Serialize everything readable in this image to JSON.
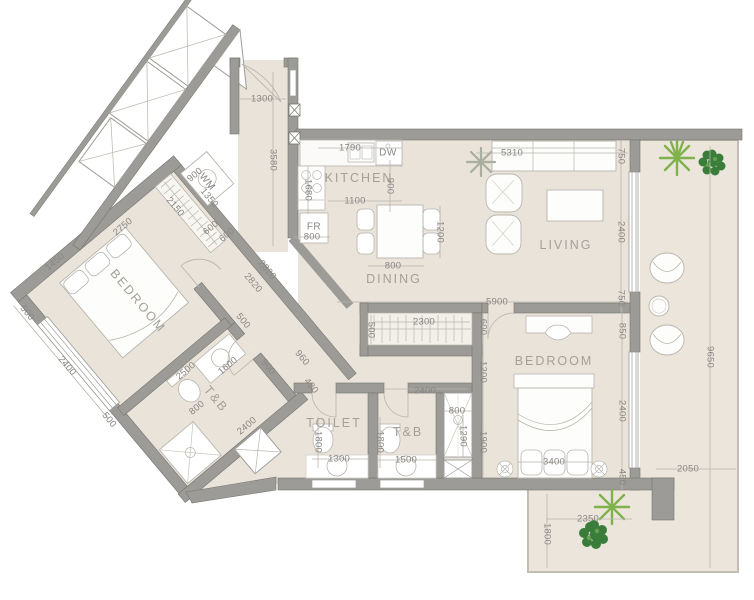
{
  "plan": {
    "type": "architectural floor plan",
    "units": "mm"
  },
  "colors": {
    "floor": "#e9e3da",
    "balcony_floor": "#ebe5dc",
    "wall": "#9c9b97",
    "wall_edge": "#76756f",
    "furniture_line": "#b9b5ad",
    "dim_line": "#b8b4ac",
    "dim_text": "#8a8784",
    "room_text": "#a4a098",
    "plant_light": "#7fb24b",
    "plant_dark": "#3a7d3b",
    "plant_gray": "#a9ae9e"
  },
  "labels": {
    "rooms": [
      {
        "text": "KITCHEN",
        "x": 359,
        "y": 178,
        "rot": 0
      },
      {
        "text": "DINING",
        "x": 394,
        "y": 279,
        "rot": 0
      },
      {
        "text": "LIVING",
        "x": 566,
        "y": 245,
        "rot": 0
      },
      {
        "text": "BEDROOM",
        "x": 554,
        "y": 361,
        "rot": 0
      },
      {
        "text": "BEDROOM",
        "x": 138,
        "y": 301,
        "rot": 50
      },
      {
        "text": "TOILET",
        "x": 334,
        "y": 423,
        "rot": 0
      },
      {
        "text": "T&B",
        "x": 408,
        "y": 432,
        "rot": 0
      },
      {
        "text": "T&B",
        "x": 216,
        "y": 399,
        "rot": 50
      }
    ],
    "appliances": [
      {
        "text": "DW",
        "x": 388,
        "y": 153,
        "rot": 0
      },
      {
        "text": "FR",
        "x": 314,
        "y": 227,
        "rot": 0
      },
      {
        "text": "WM",
        "x": 207,
        "y": 182,
        "rot": 50
      }
    ],
    "dimensions": [
      {
        "text": "1300",
        "x": 262,
        "y": 99,
        "rot": 0
      },
      {
        "text": "3580",
        "x": 273,
        "y": 160,
        "rot": 90
      },
      {
        "text": "1790",
        "x": 350,
        "y": 148,
        "rot": 0
      },
      {
        "text": "900",
        "x": 390,
        "y": 186,
        "rot": 90
      },
      {
        "text": "1680",
        "x": 308,
        "y": 190,
        "rot": 90
      },
      {
        "text": "1100",
        "x": 355,
        "y": 201,
        "rot": 0
      },
      {
        "text": "800",
        "x": 312,
        "y": 237,
        "rot": 0
      },
      {
        "text": "800",
        "x": 393,
        "y": 266,
        "rot": 0
      },
      {
        "text": "1200",
        "x": 440,
        "y": 232,
        "rot": 90
      },
      {
        "text": "5310",
        "x": 512,
        "y": 153,
        "rot": 0
      },
      {
        "text": "750",
        "x": 621,
        "y": 156,
        "rot": 90
      },
      {
        "text": "2400",
        "x": 621,
        "y": 232,
        "rot": 90
      },
      {
        "text": "750",
        "x": 621,
        "y": 298,
        "rot": 90
      },
      {
        "text": "5900",
        "x": 497,
        "y": 302,
        "rot": 0
      },
      {
        "text": "2300",
        "x": 424,
        "y": 322,
        "rot": 0
      },
      {
        "text": "500",
        "x": 371,
        "y": 330,
        "rot": 90
      },
      {
        "text": "600",
        "x": 483,
        "y": 327,
        "rot": 90
      },
      {
        "text": "1200",
        "x": 483,
        "y": 372,
        "rot": 90
      },
      {
        "text": "1900",
        "x": 483,
        "y": 442,
        "rot": 90
      },
      {
        "text": "850",
        "x": 622,
        "y": 331,
        "rot": 90
      },
      {
        "text": "2400",
        "x": 622,
        "y": 411,
        "rot": 90
      },
      {
        "text": "450",
        "x": 622,
        "y": 477,
        "rot": 90
      },
      {
        "text": "3400",
        "x": 554,
        "y": 462,
        "rot": 0
      },
      {
        "text": "2400",
        "x": 425,
        "y": 391,
        "rot": 0
      },
      {
        "text": "800",
        "x": 457,
        "y": 411,
        "rot": 0
      },
      {
        "text": "1290",
        "x": 463,
        "y": 436,
        "rot": 90
      },
      {
        "text": "1800",
        "x": 318,
        "y": 442,
        "rot": 90
      },
      {
        "text": "1300",
        "x": 339,
        "y": 459,
        "rot": 0
      },
      {
        "text": "1800",
        "x": 380,
        "y": 442,
        "rot": 90
      },
      {
        "text": "1500",
        "x": 406,
        "y": 460,
        "rot": 0
      },
      {
        "text": "430",
        "x": 311,
        "y": 386,
        "rot": 50
      },
      {
        "text": "960",
        "x": 302,
        "y": 358,
        "rot": 50
      },
      {
        "text": "900",
        "x": 268,
        "y": 367,
        "rot": 50
      },
      {
        "text": "500",
        "x": 243,
        "y": 321,
        "rot": 50
      },
      {
        "text": "2820",
        "x": 267,
        "y": 270,
        "rot": 50
      },
      {
        "text": "2820",
        "x": 253,
        "y": 283,
        "rot": 50
      },
      {
        "text": "2150",
        "x": 175,
        "y": 207,
        "rot": 50
      },
      {
        "text": "2750",
        "x": 123,
        "y": 227,
        "rot": -40
      },
      {
        "text": "1450",
        "x": 55,
        "y": 262,
        "rot": -40
      },
      {
        "text": "500",
        "x": 27,
        "y": 313,
        "rot": 50
      },
      {
        "text": "2400",
        "x": 67,
        "y": 366,
        "rot": 50
      },
      {
        "text": "500",
        "x": 109,
        "y": 420,
        "rot": 50
      },
      {
        "text": "2500",
        "x": 186,
        "y": 371,
        "rot": -40
      },
      {
        "text": "1600",
        "x": 228,
        "y": 366,
        "rot": -40
      },
      {
        "text": "800",
        "x": 197,
        "y": 408,
        "rot": -40
      },
      {
        "text": "2400",
        "x": 247,
        "y": 426,
        "rot": -40
      },
      {
        "text": "900",
        "x": 195,
        "y": 175,
        "rot": -40
      },
      {
        "text": "1350",
        "x": 209,
        "y": 198,
        "rot": 50
      },
      {
        "text": "600",
        "x": 211,
        "y": 228,
        "rot": -40
      },
      {
        "text": "600",
        "x": 227,
        "y": 235,
        "rot": -40
      },
      {
        "text": "9650",
        "x": 710,
        "y": 357,
        "rot": 90
      },
      {
        "text": "2050",
        "x": 688,
        "y": 469,
        "rot": 0
      },
      {
        "text": "2350",
        "x": 588,
        "y": 519,
        "rot": 0
      },
      {
        "text": "1800",
        "x": 547,
        "y": 534,
        "rot": 90
      }
    ]
  }
}
